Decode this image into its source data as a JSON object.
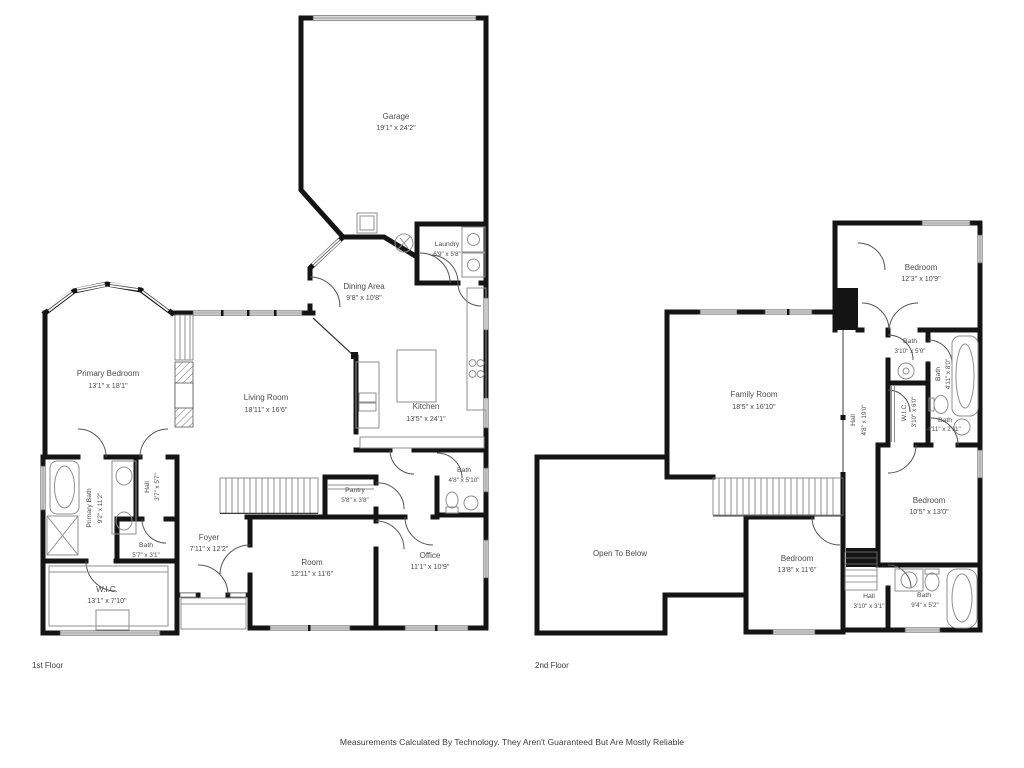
{
  "page": {
    "floor1_label": "1st Floor",
    "floor2_label": "2nd Floor",
    "disclaimer": "Measurements Calculated By Technology. They Aren't Guaranteed But Are Mostly Reliable",
    "wall_color": "#141414",
    "label_color": "#4b4b52"
  },
  "floor1": {
    "rooms": [
      {
        "name": "Garage",
        "dims": "19'1\" x 24'2\""
      },
      {
        "name": "Laundry",
        "dims": "6'9\" x 5'8\""
      },
      {
        "name": "Dining Area",
        "dims": "9'8\" x 10'8\""
      },
      {
        "name": "Primary Bedroom",
        "dims": "13'1\" x 18'1\""
      },
      {
        "name": "Living Room",
        "dims": "18'11\" x 16'6\""
      },
      {
        "name": "Kitchen",
        "dims": "13'5\" x 24'1\""
      },
      {
        "name": "Primary Bath",
        "dims": "9'2\" x 11'2\""
      },
      {
        "name": "Hall",
        "dims": "3'7\" x 5'7\""
      },
      {
        "name": "Bath",
        "dims": "5'7\" x 3'1\""
      },
      {
        "name": "W.I.C.",
        "dims": "13'1\" x 7'10\""
      },
      {
        "name": "Foyer",
        "dims": "7'11\" x 12'2\""
      },
      {
        "name": "Pantry",
        "dims": "5'8\" x 3'8\""
      },
      {
        "name": "Bath",
        "dims": "4'8\" x 5'10\""
      },
      {
        "name": "Room",
        "dims": "12'11\" x 11'6\""
      },
      {
        "name": "Office",
        "dims": "11'1\" x 10'9\""
      }
    ]
  },
  "floor2": {
    "rooms": [
      {
        "name": "Bedroom",
        "dims": "12'3\" x 10'9\""
      },
      {
        "name": "Bath",
        "dims": "3'10\" x 5'0\""
      },
      {
        "name": "Bath",
        "dims": "4'11\" x 8'0\""
      },
      {
        "name": "W.I.C.",
        "dims": "3'10\" x 6'0\""
      },
      {
        "name": "Bath",
        "dims": "4'11\" x 2'11\""
      },
      {
        "name": "Family Room",
        "dims": "18'5\" x 16'10\""
      },
      {
        "name": "Hall",
        "dims": "4'8\" x 19'0\""
      },
      {
        "name": "Bedroom",
        "dims": "10'5\" x 13'0\""
      },
      {
        "name": "Open To Below",
        "dims": ""
      },
      {
        "name": "Bedroom",
        "dims": "13'8\" x 11'6\""
      },
      {
        "name": "Hall",
        "dims": "3'10\" x 3'1\""
      },
      {
        "name": "Bath",
        "dims": "9'4\" x 5'2\""
      }
    ]
  }
}
